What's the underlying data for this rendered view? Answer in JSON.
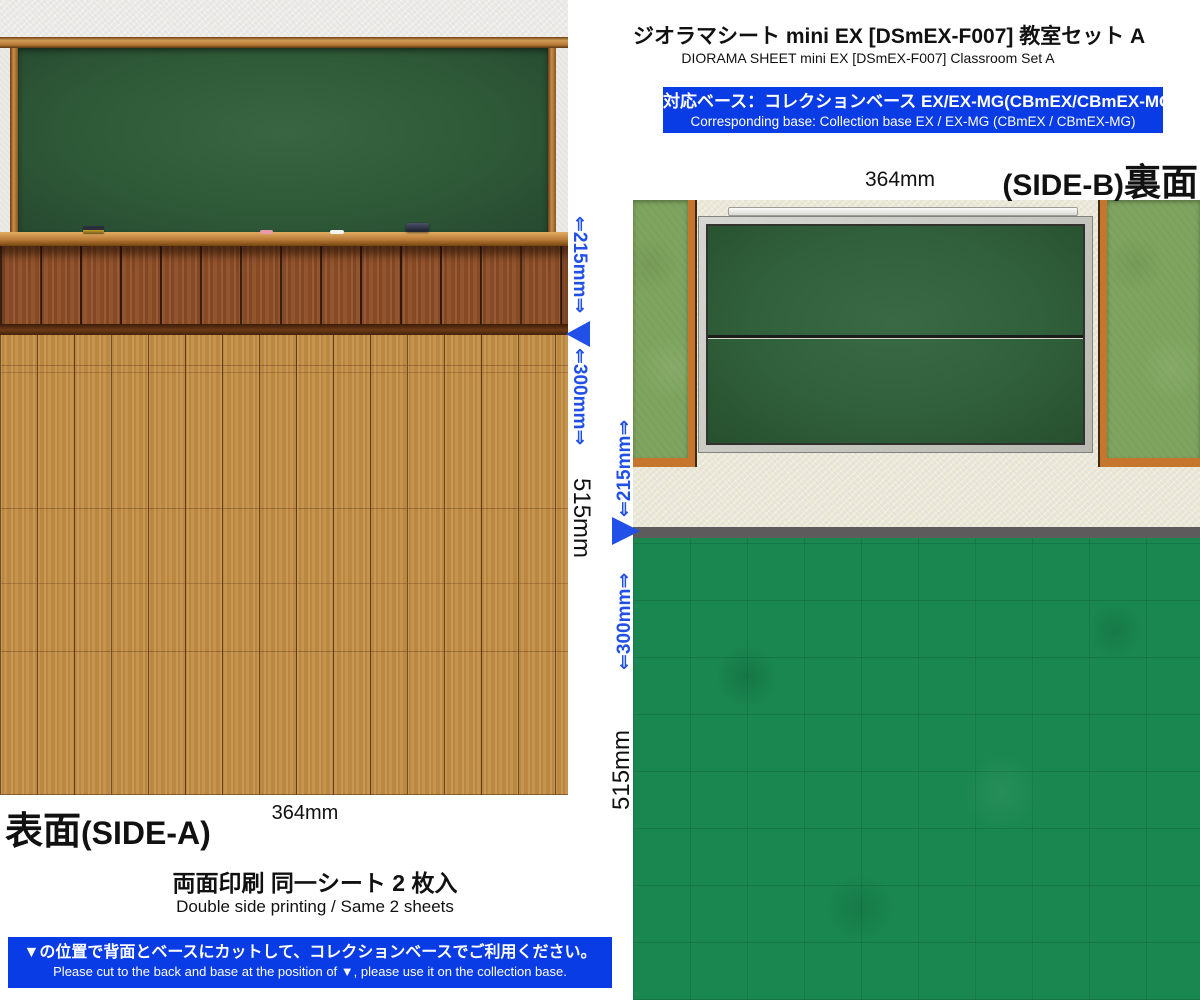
{
  "product": {
    "title_jp": "ジオラマシート mini EX [DSmEX-F007] 教室セット A",
    "title_en": "DIORAMA SHEET mini EX [DSmEX-F007] Classroom Set A"
  },
  "base_banner": {
    "line_jp": "対応ベース：コレクションベース EX/EX-MG(CBmEX/CBmEX-MG)",
    "line_en": "Corresponding base: Collection base EX / EX-MG (CBmEX / CBmEX-MG)"
  },
  "side_a": {
    "label_jp": "表面",
    "label_side": "(SIDE-A)",
    "width": "364mm",
    "height_total": "515mm",
    "height_upper": "⇐215mm⇒",
    "height_lower": "⇐300mm⇒"
  },
  "side_b": {
    "label_side": "(SIDE-B)",
    "label_jp": "裏面",
    "width": "364mm",
    "height_total": "515mm",
    "height_upper": "⇐215mm⇒",
    "height_lower": "⇐300mm⇒"
  },
  "sheet_info": {
    "line_jp": "両面印刷 同一シート 2 枚入",
    "line_en": "Double side printing / Same 2 sheets"
  },
  "cut_banner": {
    "line_jp": "▼の位置で背面とベースにカットして、コレクションベースでご利用ください。",
    "line_en": "Please cut to the back and base at the position of ▼, please use it on the collection base."
  },
  "colors": {
    "banner_blue": "#0a3ce6",
    "dimension_blue": "#2050e8",
    "chalkboard_green": "#2f5a38",
    "wainscot_wood": "#8d4e27",
    "floor_wood": "#c28e45",
    "wall_cream": "#eae7d7",
    "back_board_green": "#31603c",
    "side_panel_green": "#7fa45f",
    "floor_green": "#1a8750"
  }
}
